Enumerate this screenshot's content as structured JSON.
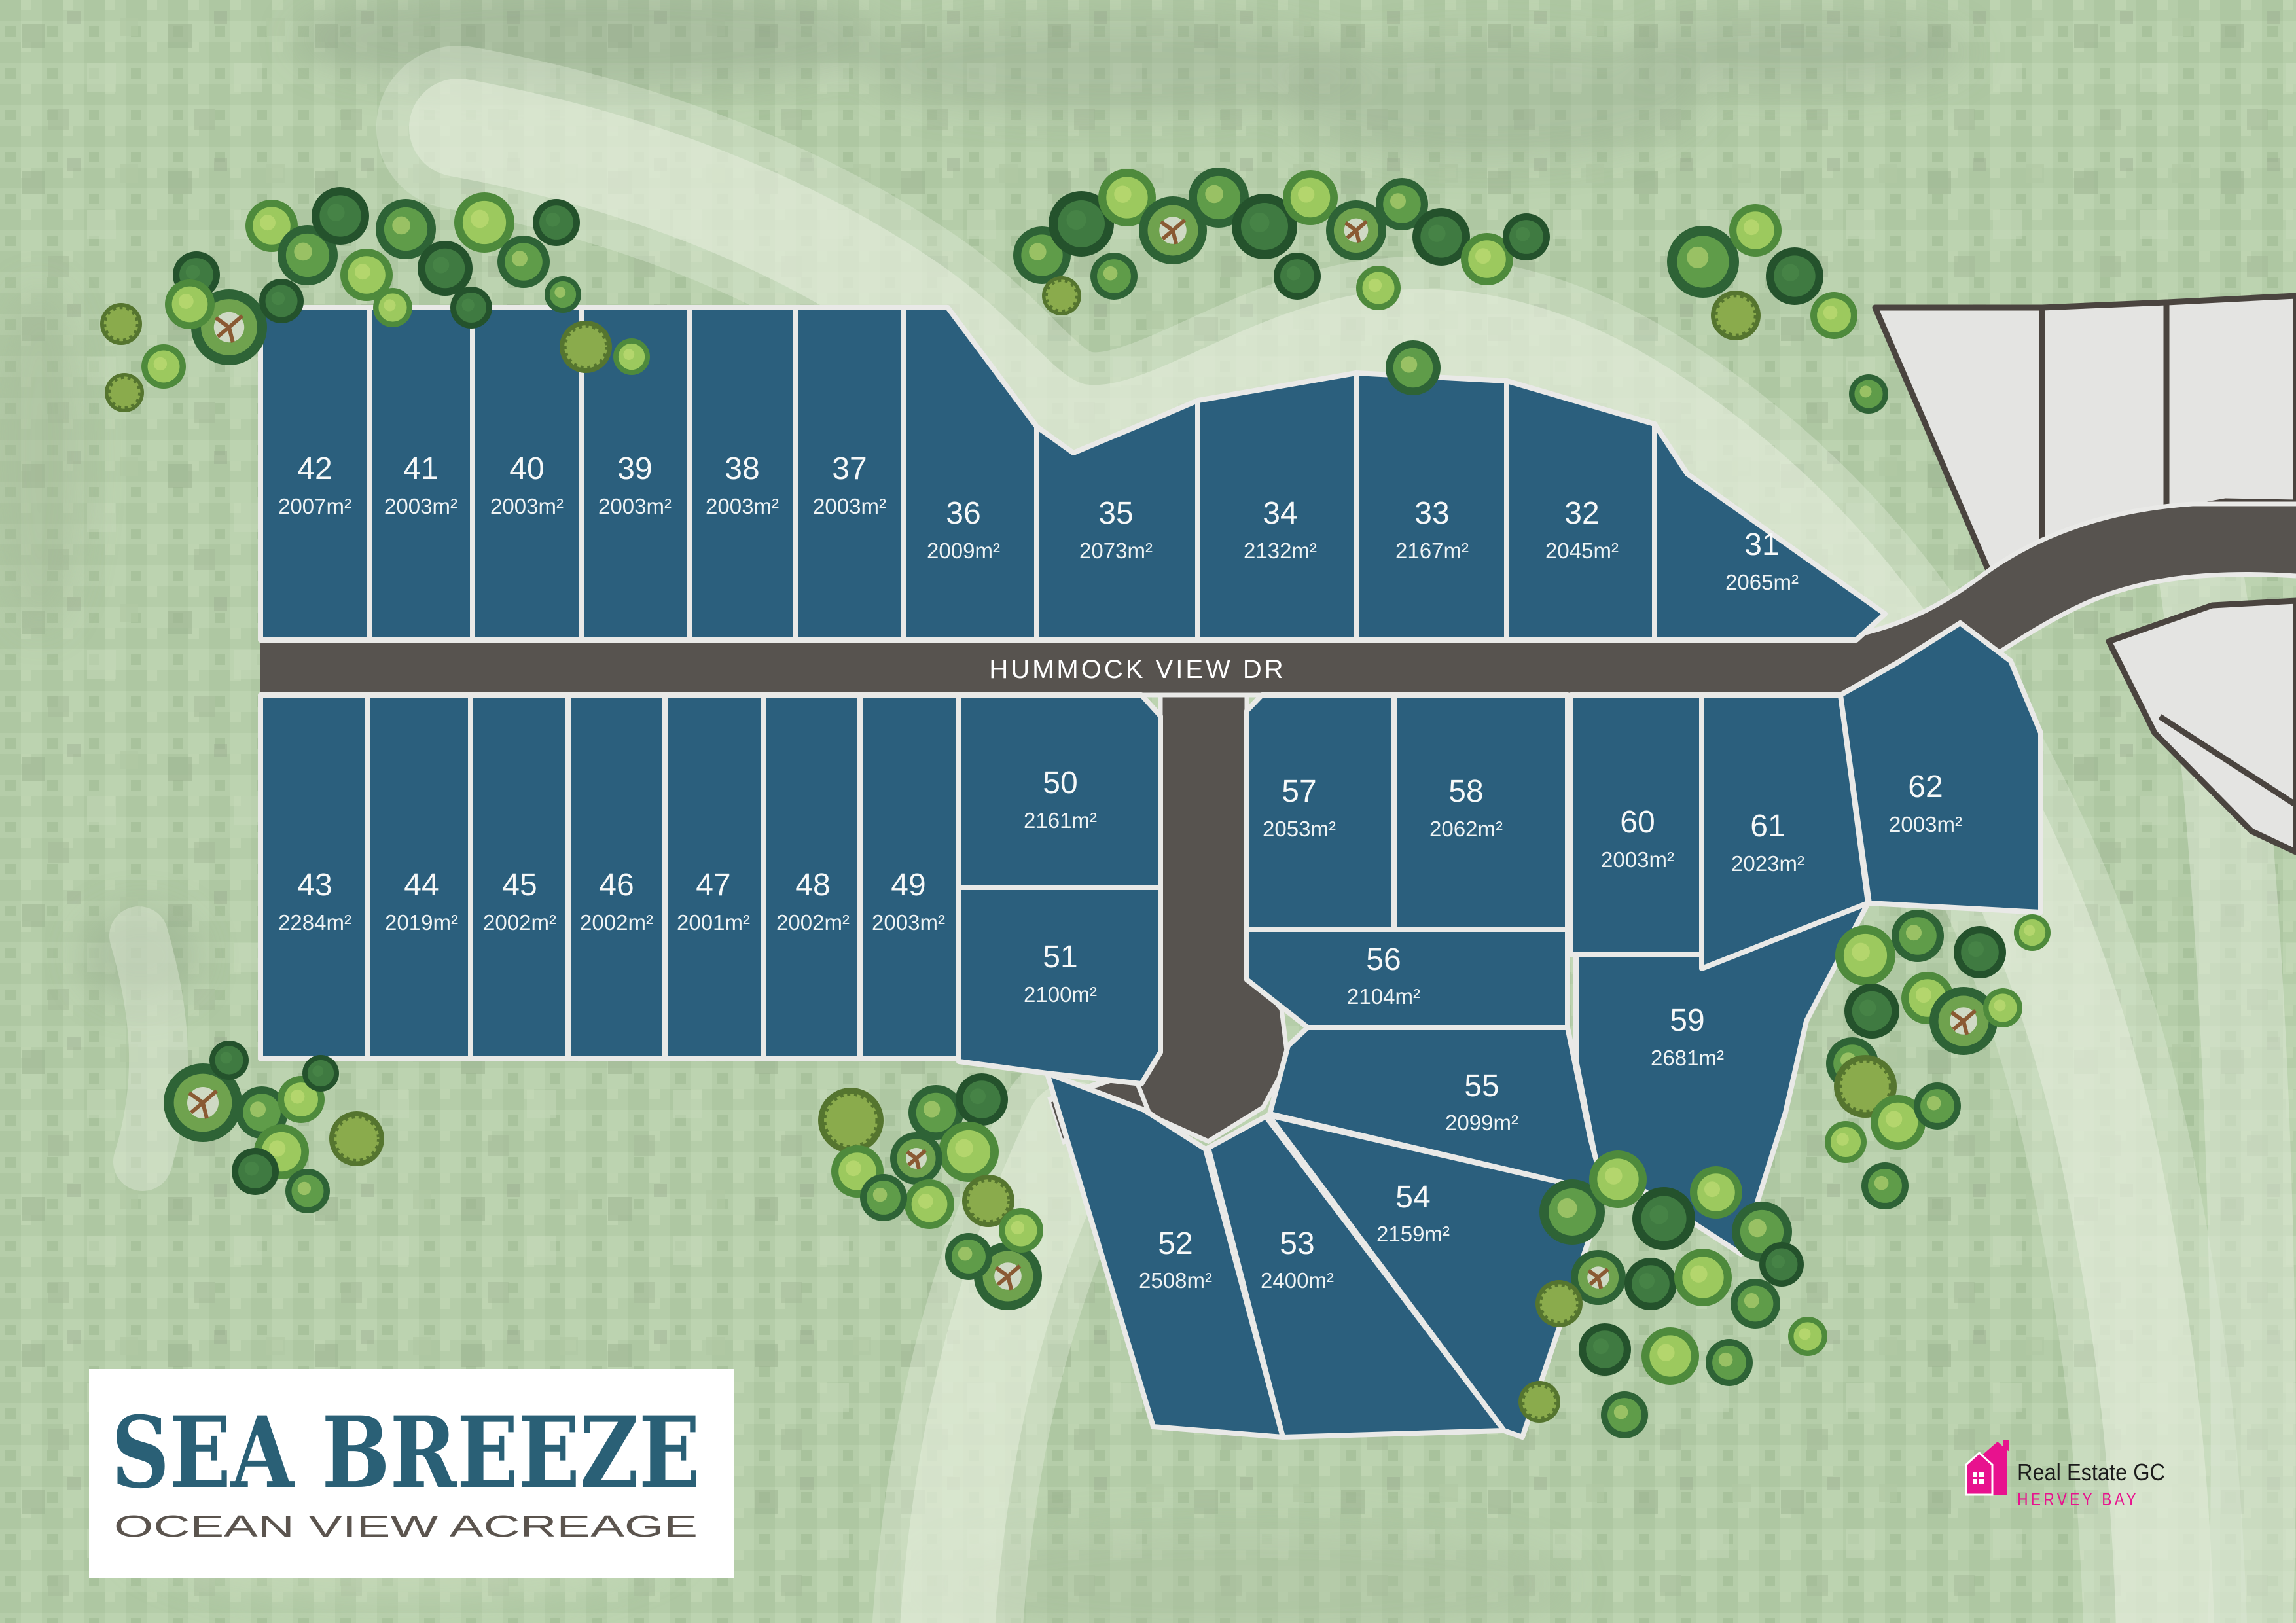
{
  "road": {
    "name": "HUMMOCK VIEW DR"
  },
  "brand": {
    "name": "SEA BREEZE",
    "tagline": "OCEAN VIEW ACREAGE"
  },
  "agency": {
    "name": "Real Estate GC",
    "location": "HERVEY BAY"
  },
  "colors": {
    "lot_fill": "#2b5f7d",
    "lot_border": "#e9e9e7",
    "road_fill": "#57534f",
    "background_green": "#b6cdaa",
    "future_lot_fill": "#e4e4e2",
    "future_lot_border": "#4a443f",
    "brand_blue": "#2a6076",
    "agency_pink": "#e8128e"
  },
  "lots": {
    "l31": {
      "number": "31",
      "area": "2065m²"
    },
    "l32": {
      "number": "32",
      "area": "2045m²"
    },
    "l33": {
      "number": "33",
      "area": "2167m²"
    },
    "l34": {
      "number": "34",
      "area": "2132m²"
    },
    "l35": {
      "number": "35",
      "area": "2073m²"
    },
    "l36": {
      "number": "36",
      "area": "2009m²"
    },
    "l37": {
      "number": "37",
      "area": "2003m²"
    },
    "l38": {
      "number": "38",
      "area": "2003m²"
    },
    "l39": {
      "number": "39",
      "area": "2003m²"
    },
    "l40": {
      "number": "40",
      "area": "2003m²"
    },
    "l41": {
      "number": "41",
      "area": "2003m²"
    },
    "l42": {
      "number": "42",
      "area": "2007m²"
    },
    "l43": {
      "number": "43",
      "area": "2284m²"
    },
    "l44": {
      "number": "44",
      "area": "2019m²"
    },
    "l45": {
      "number": "45",
      "area": "2002m²"
    },
    "l46": {
      "number": "46",
      "area": "2002m²"
    },
    "l47": {
      "number": "47",
      "area": "2001m²"
    },
    "l48": {
      "number": "48",
      "area": "2002m²"
    },
    "l49": {
      "number": "49",
      "area": "2003m²"
    },
    "l50": {
      "number": "50",
      "area": "2161m²"
    },
    "l51": {
      "number": "51",
      "area": "2100m²"
    },
    "l52": {
      "number": "52",
      "area": "2508m²"
    },
    "l53": {
      "number": "53",
      "area": "2400m²"
    },
    "l54": {
      "number": "54",
      "area": "2159m²"
    },
    "l55": {
      "number": "55",
      "area": "2099m²"
    },
    "l56": {
      "number": "56",
      "area": "2104m²"
    },
    "l57": {
      "number": "57",
      "area": "2053m²"
    },
    "l58": {
      "number": "58",
      "area": "2062m²"
    },
    "l59": {
      "number": "59",
      "area": "2681m²"
    },
    "l60": {
      "number": "60",
      "area": "2003m²"
    },
    "l61": {
      "number": "61",
      "area": "2023m²"
    },
    "l62": {
      "number": "62",
      "area": "2003m²"
    }
  }
}
